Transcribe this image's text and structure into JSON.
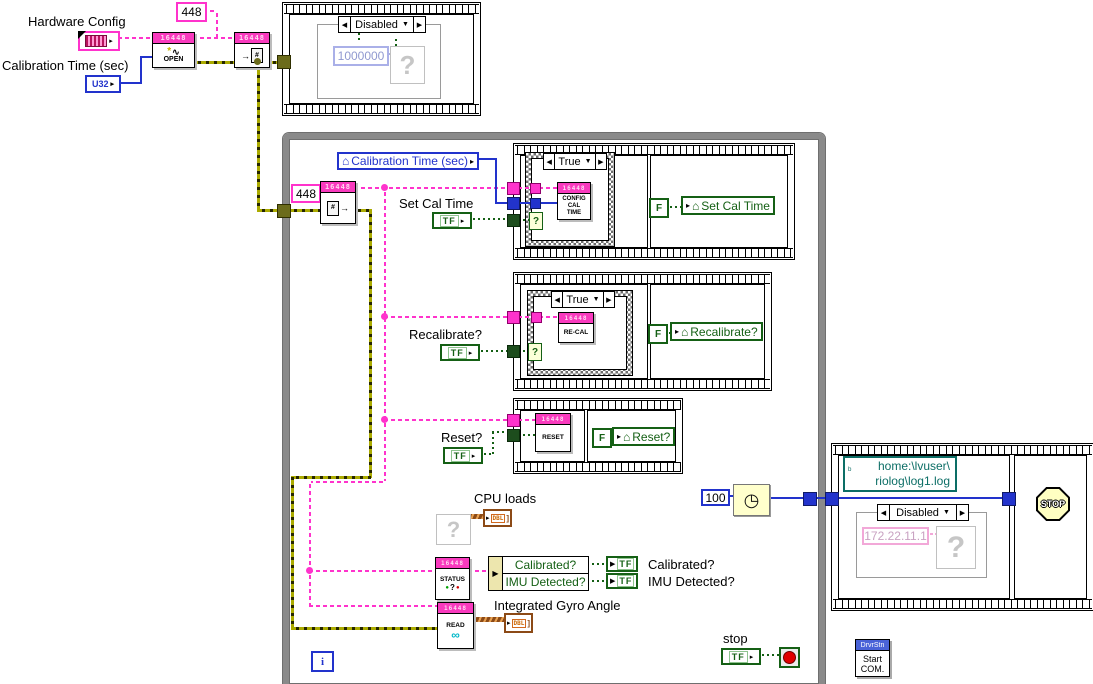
{
  "icons": {
    "arrow_left": "◀",
    "arrow_right": "▶",
    "arrow_small": "▸",
    "tri_down": "▼",
    "house": "⌂",
    "question": "?",
    "asterisk": "*",
    "wave": "∿",
    "glasses": "∞",
    "clock": "◷",
    "doc_hash": "#",
    "doc_arrow": "→",
    "dot": "●",
    "bracket_close": "]",
    "path_glyph": "ᵇ"
  },
  "header_labels": {
    "hardware_config": "Hardware Config",
    "calibration_time": "Calibration Time (sec)"
  },
  "constants": {
    "c448": "448",
    "u32": "U32",
    "c1000000": "1000000",
    "c100": "100",
    "ip_address": "172.22.11.1"
  },
  "path_constant": {
    "line1": "home:\\lvuser\\",
    "line2": "riolog\\log1.log"
  },
  "node_header": "16448",
  "nodes": {
    "open": "OPEN",
    "config_line1": "CONFIG",
    "config_line2": "CAL",
    "config_line3": "TIME",
    "recal": "RE-CAL",
    "reset": "RESET",
    "status": "STATUS",
    "read": "READ",
    "dbl": "DBL"
  },
  "selectors": {
    "disabled": "Disabled",
    "true_case": "True"
  },
  "bool": {
    "tf": "TF",
    "f": "F"
  },
  "locals": {
    "calibration_time": "Calibration Time (sec)",
    "set_cal_time": "Set Cal Time",
    "recalibrate": "Recalibrate?",
    "reset": "Reset?"
  },
  "labels": {
    "set_cal_time": "Set Cal Time",
    "recalibrate": "Recalibrate?",
    "reset": "Reset?",
    "cpu_loads": "CPU loads",
    "integrated_gyro_angle": "Integrated Gyro Angle",
    "stop": "stop",
    "calibrated": "Calibrated?",
    "imu_detected": "IMU Detected?"
  },
  "unbundle": {
    "row1": "Calibrated?",
    "row2": "IMU Detected?"
  },
  "misc": {
    "stop_sign": "STOP",
    "drvrstn": "DrvrStn",
    "start": "Start",
    "com": "COM.",
    "iteration": "i"
  },
  "colors": {
    "magenta": "#FF33CC",
    "blue": "#2233CC",
    "green": "#156015",
    "error_olive": "#ABAB00",
    "array_brown": "#8C4A16",
    "path_teal": "#0C6E66"
  }
}
